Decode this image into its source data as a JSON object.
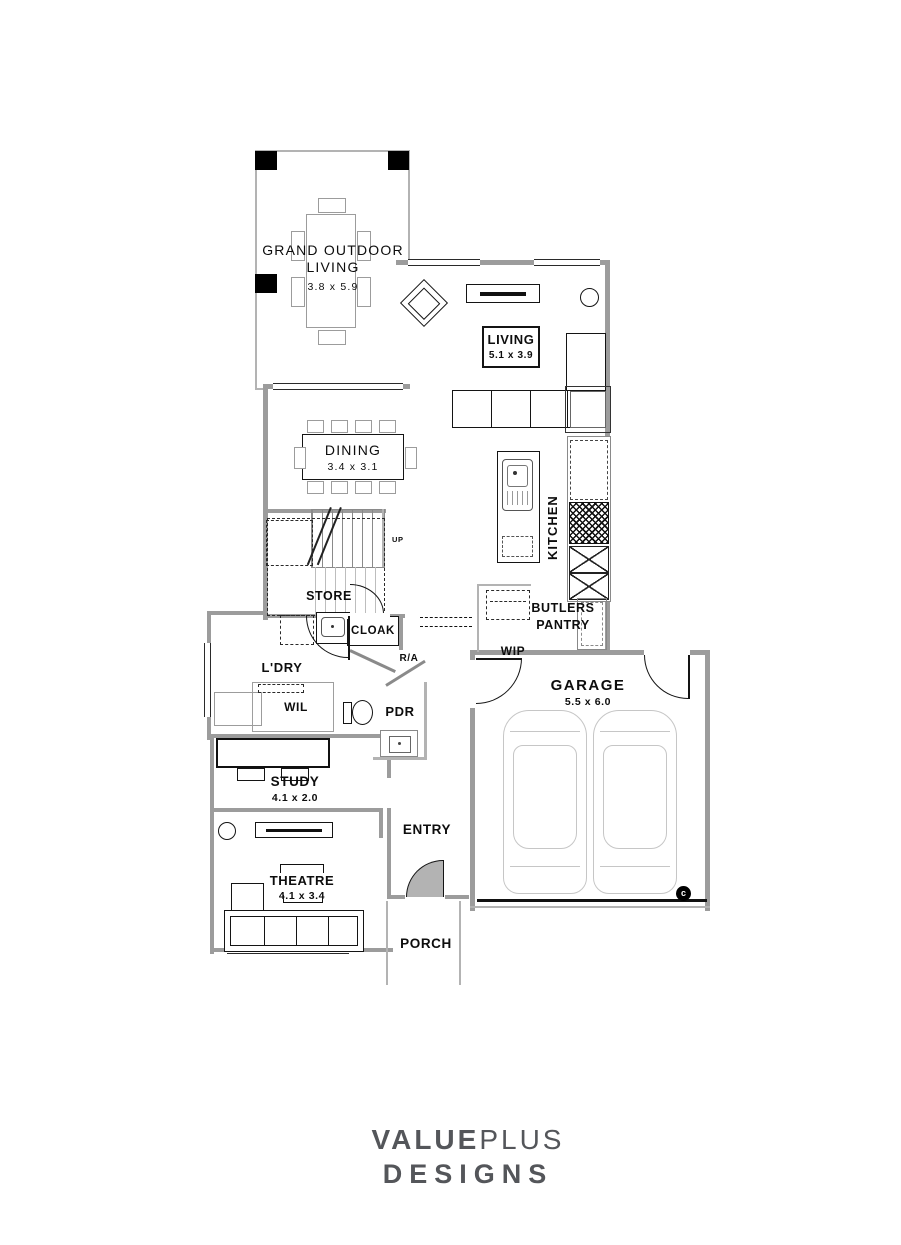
{
  "plan": {
    "rooms": {
      "grand_outdoor_living": {
        "label": "GRAND OUTDOOR LIVING",
        "dims": "3.8 x 5.9"
      },
      "living": {
        "label": "LIVING",
        "dims": "5.1 x 3.9"
      },
      "dining": {
        "label": "DINING",
        "dims": "3.4 x 3.1"
      },
      "kitchen": {
        "label": "KITCHEN"
      },
      "store": {
        "label": "STORE"
      },
      "cloak": {
        "label": "CLOAK"
      },
      "laundry": {
        "label": "L'DRY"
      },
      "wil": {
        "label": "WIL"
      },
      "pdr": {
        "label": "PDR"
      },
      "butlers_pantry": {
        "label": "BUTLERS PANTRY"
      },
      "wip": {
        "label": "WIP"
      },
      "garage": {
        "label": "GARAGE",
        "dims": "5.5 x 6.0"
      },
      "study": {
        "label": "STUDY",
        "dims": "4.1 x 2.0"
      },
      "entry": {
        "label": "ENTRY"
      },
      "theatre": {
        "label": "THEATRE",
        "dims": "4.1 x 3.4"
      },
      "porch": {
        "label": "PORCH"
      }
    },
    "annotations": {
      "stairs_up": "UP",
      "return_air": "R/A",
      "copyright": "c"
    }
  },
  "branding": {
    "name_strong": "VALUE",
    "name_light": "PLUS",
    "line2": "DESIGNS"
  },
  "colors": {
    "wall": "#9c9c9c",
    "line": "#141414",
    "light_line": "#c6c6c6",
    "text": "#0d0d0d",
    "logo": "#54565a"
  }
}
